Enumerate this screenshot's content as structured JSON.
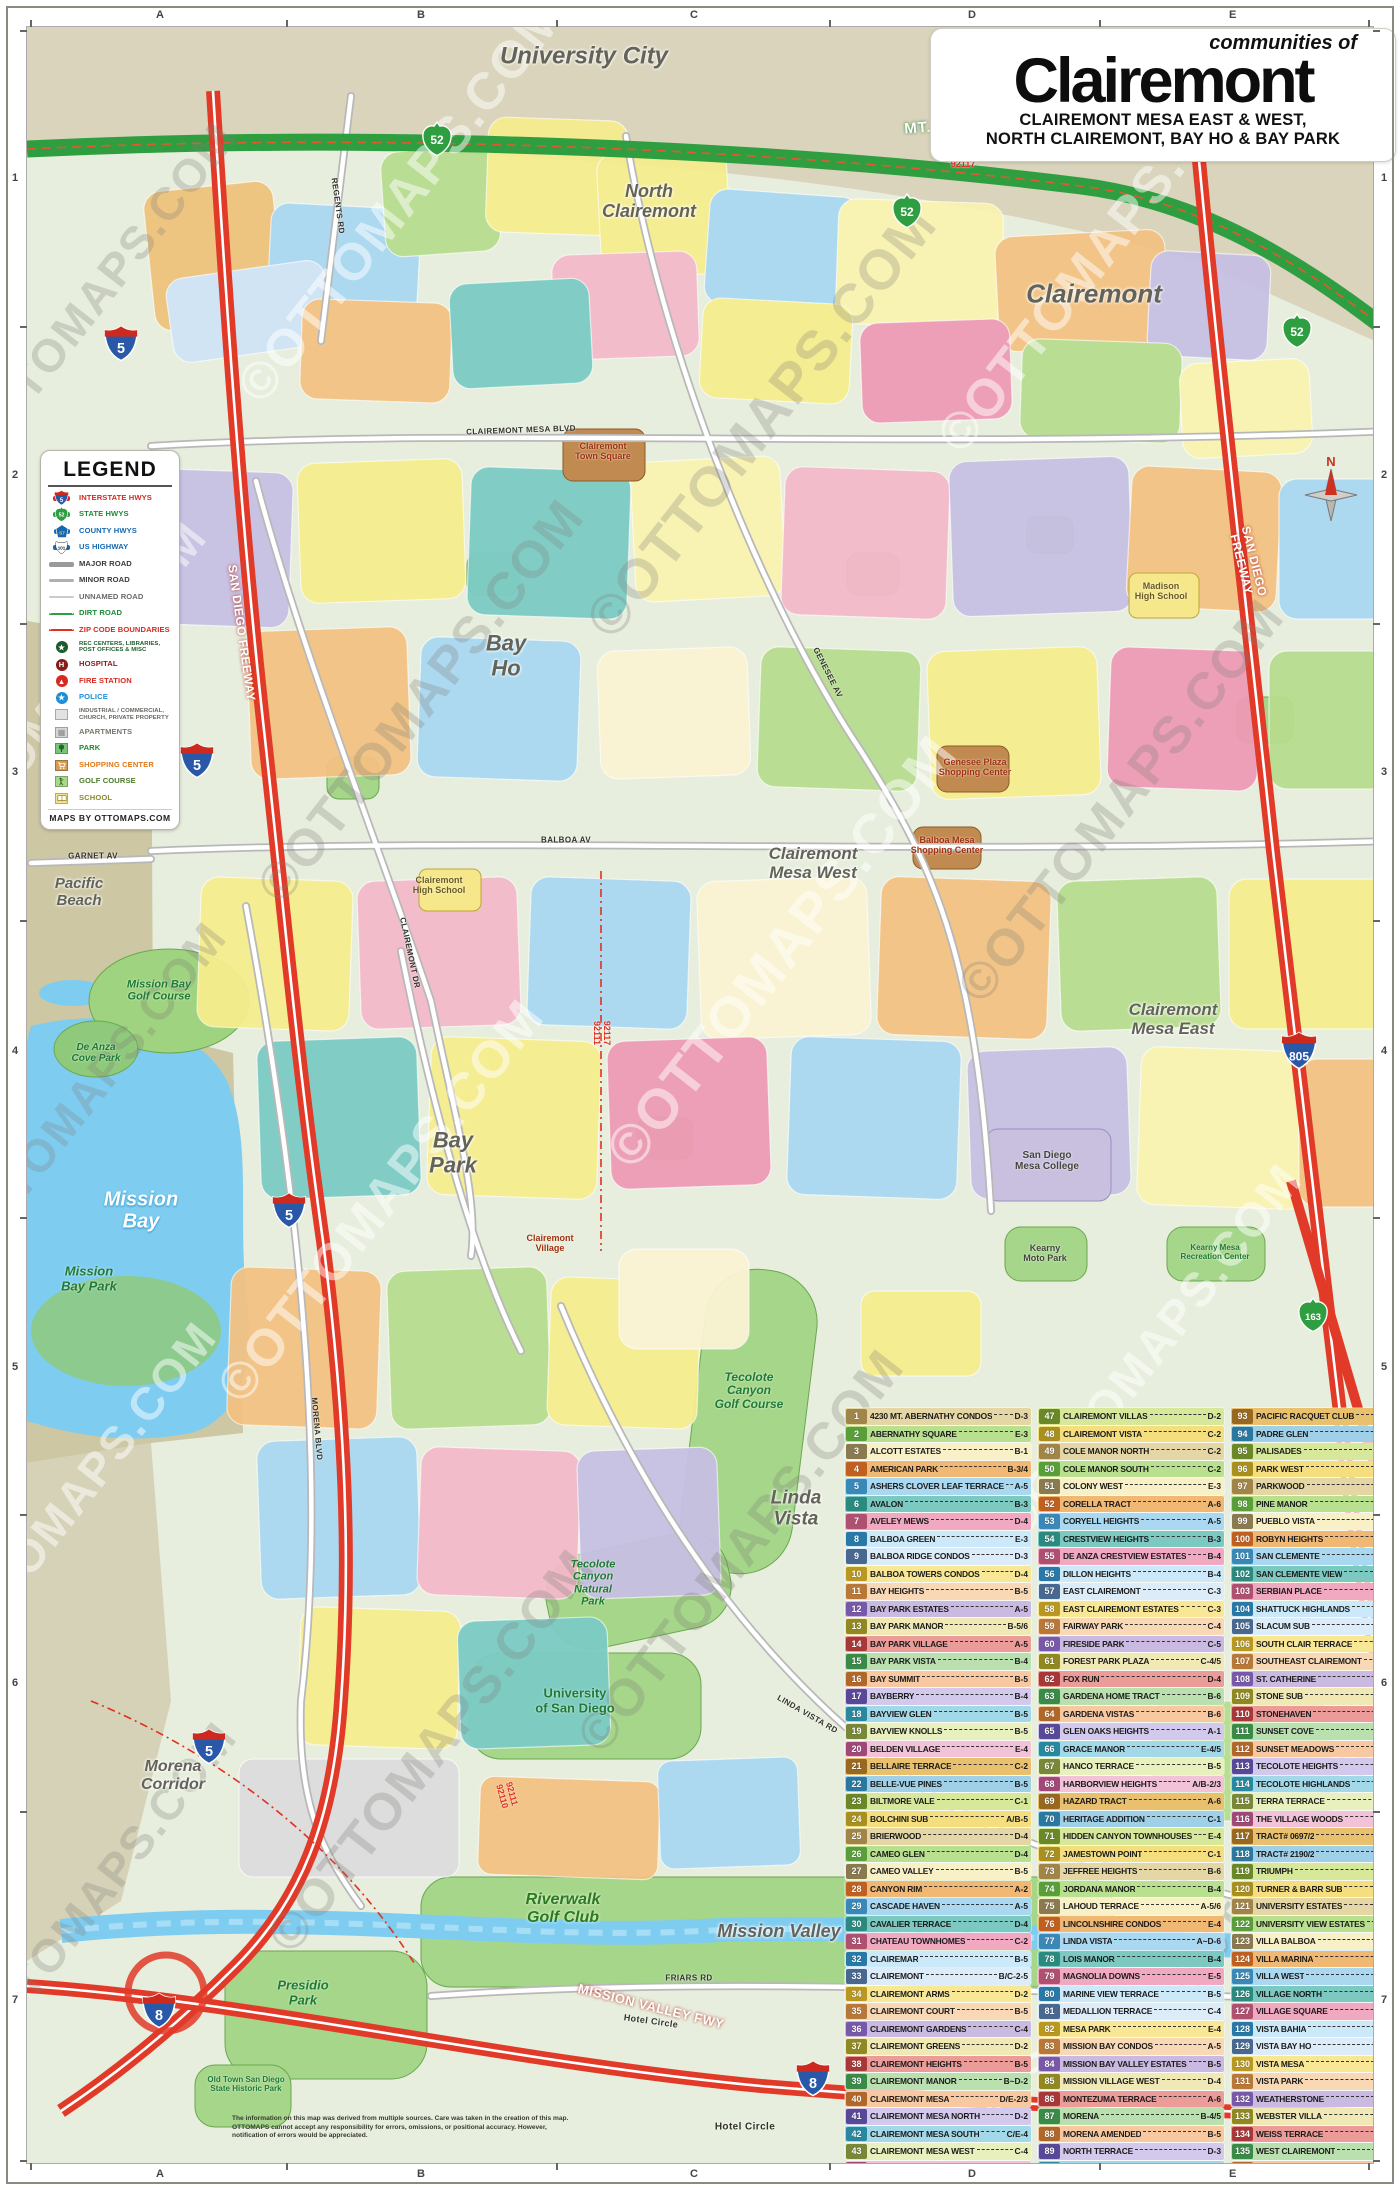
{
  "title": {
    "kicker": "communities of",
    "main": "Clairemont",
    "sub1": "CLAIREMONT MESA EAST & WEST,",
    "sub2": "NORTH CLAIREMONT, BAY HO & BAY PARK"
  },
  "legend": {
    "title": "LEGEND",
    "footer": "MAPS BY OTTOMAPS.COM",
    "items": [
      {
        "label": "INTERSTATE HWYS",
        "icon": "interstate",
        "color": "#d62a20"
      },
      {
        "label": "STATE HWYS",
        "icon": "state",
        "color": "#1d8a35"
      },
      {
        "label": "COUNTY HWYS",
        "icon": "county",
        "color": "#1668b3"
      },
      {
        "label": "US HIGHWAY",
        "icon": "us",
        "color": "#1668b3"
      },
      {
        "label": "MAJOR ROAD",
        "icon": "major-road",
        "color": "#3a3a3a"
      },
      {
        "label": "MINOR ROAD",
        "icon": "minor-road",
        "color": "#3a3a3a"
      },
      {
        "label": "UNNAMED ROAD",
        "icon": "unnamed-road",
        "color": "#6a6a6a"
      },
      {
        "label": "DIRT ROAD",
        "icon": "dirt-road",
        "color": "#1d8a35"
      },
      {
        "label": "ZIP CODE BOUNDARIES",
        "icon": "zip",
        "color": "#d62a20"
      },
      {
        "label": "REC CENTERS, LIBRARIES,\nPOST OFFICES & MISC",
        "icon": "civic",
        "color": "#1a5c2a",
        "small": true
      },
      {
        "label": "HOSPITAL",
        "icon": "hospital",
        "color": "#8a1a1a"
      },
      {
        "label": "FIRE STATION",
        "icon": "fire",
        "color": "#d62a20"
      },
      {
        "label": "POLICE",
        "icon": "police",
        "color": "#1d8fd6"
      },
      {
        "label": "INDUSTRIAL / COMMERCIAL,\nCHURCH, PRIVATE PROPERTY",
        "icon": "industrial",
        "color": "#666660",
        "small": true
      },
      {
        "label": "APARTMENTS",
        "icon": "apartments",
        "color": "#77776e"
      },
      {
        "label": "PARK",
        "icon": "park",
        "color": "#1d8a35"
      },
      {
        "label": "SHOPPING CENTER",
        "icon": "shopping",
        "color": "#e07818"
      },
      {
        "label": "GOLF COURSE",
        "icon": "golf",
        "color": "#4a7a28"
      },
      {
        "label": "SCHOOL",
        "icon": "school",
        "color": "#8a8a30"
      }
    ]
  },
  "grid": {
    "letters": [
      "A",
      "B",
      "C",
      "D",
      "E"
    ],
    "numbers": [
      "1",
      "2",
      "3",
      "4",
      "5",
      "6",
      "7"
    ]
  },
  "watermark": "©OTTOMAPS.COM",
  "disclaimer": "The information on this map was derived from multiple sources. Care was taken in the creation of this map. OTTOMAPS cannot accept any responsibility for errors, omissions, or positional accuracy. However, notification of errors would be appreciated.",
  "map": {
    "labels": [
      [
        "University City",
        583,
        56,
        "area",
        24,
        0
      ],
      [
        "Clairemont",
        1093,
        293,
        "area",
        26,
        0
      ],
      [
        "North\nClairemont",
        648,
        200,
        "area",
        18,
        0
      ],
      [
        "Bay\nHo",
        505,
        655,
        "area",
        22,
        0
      ],
      [
        "Clairemont\nMesa West",
        812,
        862,
        "area",
        17,
        0
      ],
      [
        "Clairemont\nMesa East",
        1172,
        1018,
        "area",
        17,
        0
      ],
      [
        "Bay\nPark",
        452,
        1152,
        "area",
        22,
        0
      ],
      [
        "Pacific\nBeach",
        78,
        892,
        "area",
        15,
        0
      ],
      [
        "Linda\nVista",
        795,
        1508,
        "area",
        19,
        0
      ],
      [
        "Morena\nCorridor",
        172,
        1775,
        "area",
        16,
        0
      ],
      [
        "Mission Valley",
        778,
        1930,
        "area",
        18,
        0
      ],
      [
        "Mission\nBay",
        140,
        1210,
        "water",
        20,
        0
      ],
      [
        "Mission\nBay Park",
        88,
        1278,
        "park",
        13,
        0
      ],
      [
        "Mission Bay\nGolf Course",
        158,
        990,
        "park",
        11,
        0
      ],
      [
        "De Anza\nCove Park",
        95,
        1052,
        "park",
        10,
        0
      ],
      [
        "Tecolote\nCanyon\nGolf Course",
        748,
        1390,
        "park",
        12,
        0
      ],
      [
        "Tecolote\nCanyon\nNatural\nPark",
        592,
        1582,
        "park",
        11,
        0
      ],
      [
        "University\nof San Diego",
        574,
        1700,
        "parksm",
        13,
        0
      ],
      [
        "Riverwalk\nGolf Club",
        562,
        1908,
        "golf",
        16,
        0
      ],
      [
        "Presidio\nPark",
        302,
        1992,
        "park",
        13,
        0
      ],
      [
        "Old Town San Diego\nState Historic Park",
        245,
        2084,
        "parksm",
        8,
        0
      ],
      [
        "Hotel Circle",
        650,
        2020,
        "street",
        9,
        8
      ],
      [
        "Hotel Circle",
        744,
        2126,
        "street",
        10,
        0
      ],
      [
        "Clairemont\nTown Square",
        602,
        450,
        "poired",
        9,
        0
      ],
      [
        "Genesee Plaza\nShopping Center",
        974,
        766,
        "poired",
        9,
        0
      ],
      [
        "Balboa Mesa\nShopping Center",
        946,
        844,
        "poired",
        9,
        0
      ],
      [
        "San Diego\nMesa College",
        1046,
        1160,
        "poidark",
        10,
        0
      ],
      [
        "Kearny\nMoto Park",
        1044,
        1252,
        "poidark",
        9,
        0
      ],
      [
        "Kearny Mesa\nRecreation Center",
        1214,
        1252,
        "parksm",
        8,
        0
      ],
      [
        "Clairemont\nHigh School",
        438,
        884,
        "school",
        9,
        0
      ],
      [
        "Madison\nHigh School",
        1160,
        590,
        "school",
        9,
        0
      ],
      [
        "Clairemont\nVillage",
        549,
        1242,
        "poired",
        9,
        0
      ],
      [
        "MT. SOLEDAD FREEWAY",
        1002,
        122,
        "fwyg",
        15,
        -4
      ],
      [
        "SAN DIEGO FREEWAY",
        240,
        632,
        "fwyr",
        12,
        82
      ],
      [
        "SAN DIEGO FREEWAY",
        1246,
        562,
        "fwyr",
        12,
        76
      ],
      [
        "MISSION VALLEY FWY",
        650,
        2006,
        "fwyr",
        13,
        14
      ],
      [
        "92122\n92117",
        962,
        158,
        "zip",
        9,
        0
      ],
      [
        "92117\n92111",
        601,
        1032,
        "zip",
        9,
        90
      ],
      [
        "92111\n92110",
        506,
        1794,
        "zip",
        9,
        75
      ],
      [
        "CLAIREMONT MESA BLVD",
        520,
        430,
        "street",
        8,
        -2
      ],
      [
        "BALBOA AV",
        565,
        840,
        "street",
        8,
        0
      ],
      [
        "GENESEE AV",
        826,
        672,
        "street",
        8,
        63
      ],
      [
        "CLAIREMONT DR",
        408,
        952,
        "street",
        8,
        78
      ],
      [
        "MORENA BLVD",
        315,
        1428,
        "street",
        8,
        85
      ],
      [
        "LINDA VISTA RD",
        806,
        1714,
        "street",
        8,
        30
      ],
      [
        "GARNET AV",
        92,
        856,
        "street",
        8,
        0
      ],
      [
        "FRIARS RD",
        688,
        1978,
        "street",
        8,
        0
      ],
      [
        "REGENTS RD",
        336,
        205,
        "street",
        8,
        82
      ]
    ],
    "shields": [
      [
        "i",
        "5",
        120,
        345,
        36
      ],
      [
        "i",
        "5",
        196,
        762,
        36
      ],
      [
        "i",
        "5",
        288,
        1212,
        36
      ],
      [
        "i",
        "5",
        208,
        1748,
        36
      ],
      [
        "i",
        "805",
        1205,
        130,
        38
      ],
      [
        "i",
        "805",
        1298,
        1052,
        38
      ],
      [
        "i",
        "8",
        158,
        2012,
        36
      ],
      [
        "i",
        "8",
        812,
        2080,
        36
      ],
      [
        "s",
        "52",
        436,
        140,
        34
      ],
      [
        "s",
        "52",
        906,
        212,
        34
      ],
      [
        "s",
        "52",
        1296,
        332,
        34
      ],
      [
        "s",
        "163",
        1312,
        1316,
        34
      ]
    ],
    "compass_label": "N"
  },
  "index": {
    "entries": [
      [
        1,
        "4230 MT. ABERNATHY CONDOS",
        "D-3"
      ],
      [
        2,
        "ABERNATHY SQUARE",
        "E-3"
      ],
      [
        3,
        "ALCOTT ESTATES",
        "B-1"
      ],
      [
        4,
        "AMERICAN PARK",
        "B-3/4"
      ],
      [
        5,
        "ASHERS CLOVER LEAF TERRACE",
        "A-5"
      ],
      [
        6,
        "AVALON",
        "B-3"
      ],
      [
        7,
        "AVELEY MEWS",
        "D-4"
      ],
      [
        8,
        "BALBOA GREEN",
        "E-3"
      ],
      [
        9,
        "BALBOA RIDGE CONDOS",
        "D-3"
      ],
      [
        10,
        "BALBOA TOWERS CONDOS",
        "D-4"
      ],
      [
        11,
        "BAY HEIGHTS",
        "B-5"
      ],
      [
        12,
        "BAY PARK ESTATES",
        "A-5"
      ],
      [
        13,
        "BAY PARK MANOR",
        "B-5/6"
      ],
      [
        14,
        "BAY PARK VILLAGE",
        "A-5"
      ],
      [
        15,
        "BAY PARK VISTA",
        "B-4"
      ],
      [
        16,
        "BAY SUMMIT",
        "B-5"
      ],
      [
        17,
        "BAYBERRY",
        "B-4"
      ],
      [
        18,
        "BAYVIEW GLEN",
        "B-5"
      ],
      [
        19,
        "BAYVIEW KNOLLS",
        "B-5"
      ],
      [
        20,
        "BELDEN VILLAGE",
        "E-4"
      ],
      [
        21,
        "BELLAIRE TERRACE",
        "C-2"
      ],
      [
        22,
        "BELLE-VUE PINES",
        "B-5"
      ],
      [
        23,
        "BILTMORE VALE",
        "C-1"
      ],
      [
        24,
        "BOLCHINI SUB",
        "A/B-5"
      ],
      [
        25,
        "BRIERWOOD",
        "D-4"
      ],
      [
        26,
        "CAMEO GLEN",
        "D-4"
      ],
      [
        27,
        "CAMEO VALLEY",
        "B-5"
      ],
      [
        28,
        "CANYON RIM",
        "A-2"
      ],
      [
        29,
        "CASCADE HAVEN",
        "A-5"
      ],
      [
        30,
        "CAVALIER TERRACE",
        "D-4"
      ],
      [
        31,
        "CHATEAU TOWNHOMES",
        "C-2"
      ],
      [
        32,
        "CLAIREMAR",
        "B-5"
      ],
      [
        33,
        "CLAIREMONT",
        "B/C-2-5"
      ],
      [
        34,
        "CLAIREMONT ARMS",
        "D-2"
      ],
      [
        35,
        "CLAIREMONT COURT",
        "B-5"
      ],
      [
        36,
        "CLAIREMONT GARDENS",
        "C-4"
      ],
      [
        37,
        "CLAIREMONT GREENS",
        "D-2"
      ],
      [
        38,
        "CLAIREMONT HEIGHTS",
        "B-5"
      ],
      [
        39,
        "CLAIREMONT MANOR",
        "B~D-2"
      ],
      [
        40,
        "CLAIREMONT MESA",
        "D/E-2/3"
      ],
      [
        41,
        "CLAIREMONT MESA NORTH",
        "D-2"
      ],
      [
        42,
        "CLAIREMONT MESA SOUTH",
        "C/E-4"
      ],
      [
        43,
        "CLAIREMONT MESA WEST",
        "C-4"
      ],
      [
        44,
        "CLAIREMONT PARK",
        "C-4"
      ],
      [
        45,
        "CLAIREMONT TERRACE",
        "B-5"
      ],
      [
        46,
        "CLAIREMONT VILLAGE",
        "B-3"
      ],
      [
        47,
        "CLAIREMONT VILLAS",
        "D-2"
      ],
      [
        48,
        "CLAIREMONT VISTA",
        "C-2"
      ],
      [
        49,
        "COLE MANOR NORTH",
        "C-2"
      ],
      [
        50,
        "COLE MANOR SOUTH",
        "C-2"
      ],
      [
        51,
        "COLONY WEST",
        "E-3"
      ],
      [
        52,
        "CORELLA TRACT",
        "A-6"
      ],
      [
        53,
        "CORYELL HEIGHTS",
        "A-5"
      ],
      [
        54,
        "CRESTVIEW HEIGHTS",
        "B-3"
      ],
      [
        55,
        "DE ANZA CRESTVIEW ESTATES",
        "B-4"
      ],
      [
        56,
        "DILLON HEIGHTS",
        "B-4"
      ],
      [
        57,
        "EAST CLAIREMONT",
        "C-3"
      ],
      [
        58,
        "EAST CLAIREMONT ESTATES",
        "C-3"
      ],
      [
        59,
        "FAIRWAY PARK",
        "C-4"
      ],
      [
        60,
        "FIRESIDE PARK",
        "C-5"
      ],
      [
        61,
        "FOREST PARK PLAZA",
        "C-4/5"
      ],
      [
        62,
        "FOX RUN",
        "D-4"
      ],
      [
        63,
        "GARDENA HOME TRACT",
        "B-6"
      ],
      [
        64,
        "GARDENA VISTAS",
        "B-6"
      ],
      [
        65,
        "GLEN OAKS HEIGHTS",
        "A-1"
      ],
      [
        66,
        "GRACE MANOR",
        "E-4/5"
      ],
      [
        67,
        "HANCO TERRACE",
        "B-5"
      ],
      [
        68,
        "HARBORVIEW HEIGHTS",
        "A/B-2/3"
      ],
      [
        69,
        "HAZARD TRACT",
        "A-6"
      ],
      [
        70,
        "HERITAGE ADDITION",
        "C-1"
      ],
      [
        71,
        "HIDDEN CANYON TOWNHOUSES",
        "E-4"
      ],
      [
        72,
        "JAMESTOWN POINT",
        "C-1"
      ],
      [
        73,
        "JEFFREE HEIGHTS",
        "B-6"
      ],
      [
        74,
        "JORDANA MANOR",
        "B-4"
      ],
      [
        75,
        "LAHOUD TERRACE",
        "A-5/6"
      ],
      [
        76,
        "LINCOLNSHIRE CONDOS",
        "E-4"
      ],
      [
        77,
        "LINDA VISTA",
        "A~D-6"
      ],
      [
        78,
        "LOIS MANOR",
        "B-4"
      ],
      [
        79,
        "MAGNOLIA DOWNS",
        "E-5"
      ],
      [
        80,
        "MARINE VIEW TERRACE",
        "B-5"
      ],
      [
        81,
        "MEDALLION TERRACE",
        "C-4"
      ],
      [
        82,
        "MESA PARK",
        "E-4"
      ],
      [
        83,
        "MISSION BAY CONDOS",
        "A-5"
      ],
      [
        84,
        "MISSION BAY VALLEY ESTATES",
        "B-5"
      ],
      [
        85,
        "MISSION VILLAGE WEST",
        "D-4"
      ],
      [
        86,
        "MONTEZUMA TERRACE",
        "A-6"
      ],
      [
        87,
        "MORENA",
        "B-4/5"
      ],
      [
        88,
        "MORENA AMENDED",
        "B-5"
      ],
      [
        89,
        "NORTH TERRACE",
        "D-3"
      ],
      [
        90,
        "NORTHEAST CLAIREMONT",
        "D-2"
      ],
      [
        91,
        "NORTON SUB",
        "A-5"
      ],
      [
        92,
        "PACIFIC BLUFFS",
        "B-3"
      ],
      [
        93,
        "PACIFIC RACQUET CLUB",
        "B-3"
      ],
      [
        94,
        "PADRE GLEN",
        "B-4"
      ],
      [
        95,
        "PALISADES",
        "A-1/2"
      ],
      [
        96,
        "PARK WEST",
        "B-1"
      ],
      [
        97,
        "PARKWOOD",
        "C-3"
      ],
      [
        98,
        "PINE MANOR",
        "B-5"
      ],
      [
        99,
        "PUEBLO VISTA",
        "E-5"
      ],
      [
        100,
        "ROBYN HEIGHTS",
        "B-3"
      ],
      [
        101,
        "SAN CLEMENTE",
        "C-1"
      ],
      [
        102,
        "SAN CLEMENTE VIEW",
        "C-1"
      ],
      [
        103,
        "SERBIAN PLACE",
        "B-4"
      ],
      [
        104,
        "SHATTUCK HIGHLANDS",
        "B-1"
      ],
      [
        105,
        "SLACUM SUB",
        "B-5"
      ],
      [
        106,
        "SOUTH CLAIR TERRACE",
        "C-5"
      ],
      [
        107,
        "SOUTHEAST CLAIREMONT",
        "D-4"
      ],
      [
        108,
        "ST. CATHERINE",
        "D-3"
      ],
      [
        109,
        "STONE SUB",
        "B-5"
      ],
      [
        110,
        "STONEHAVEN",
        "A-2"
      ],
      [
        111,
        "SUNSET COVE",
        "C-4"
      ],
      [
        112,
        "SUNSET MEADOWS",
        "E-5"
      ],
      [
        113,
        "TECOLOTE HEIGHTS",
        "C-6"
      ],
      [
        114,
        "TECOLOTE HIGHLANDS",
        "C-5"
      ],
      [
        115,
        "TERRA TERRACE",
        "B-5/6"
      ],
      [
        116,
        "THE VILLAGE WOODS",
        "E-5"
      ],
      [
        117,
        "TRACT# 0697/2",
        "B-5"
      ],
      [
        118,
        "TRACT# 2190/2",
        "B-5"
      ],
      [
        119,
        "TRIUMPH",
        "E-3"
      ],
      [
        120,
        "TURNER & BARR SUB",
        "A-5"
      ],
      [
        121,
        "UNIVERSITY ESTATES",
        "B-6"
      ],
      [
        122,
        "UNIVERSITY VIEW ESTATES",
        "E-2"
      ],
      [
        123,
        "VILLA BALBOA",
        "E-3"
      ],
      [
        124,
        "VILLA MARINA",
        "B-3"
      ],
      [
        125,
        "VILLA WEST",
        "E-3"
      ],
      [
        126,
        "VILLAGE NORTH",
        "E-4"
      ],
      [
        127,
        "VILLAGE SQUARE",
        "C-3"
      ],
      [
        128,
        "VISTA BAHIA",
        "B-4"
      ],
      [
        129,
        "VISTA BAY HO",
        "A-2"
      ],
      [
        130,
        "VISTA MESA",
        "E-4"
      ],
      [
        131,
        "VISTA PARK",
        "E-4"
      ],
      [
        132,
        "WEATHERSTONE",
        "C-4"
      ],
      [
        133,
        "WEBSTER VILLA",
        "B-4"
      ],
      [
        134,
        "WEISS TERRACE",
        "E-5"
      ],
      [
        135,
        "WEST CLAIREMONT",
        "A/B-2"
      ],
      [
        136,
        "WESTERN HILLS",
        "B-5"
      ],
      [
        137,
        "WESTON HIGHLANDS",
        "B-5"
      ],
      [
        138,
        "WESTRIDGE",
        "C-2"
      ]
    ]
  }
}
